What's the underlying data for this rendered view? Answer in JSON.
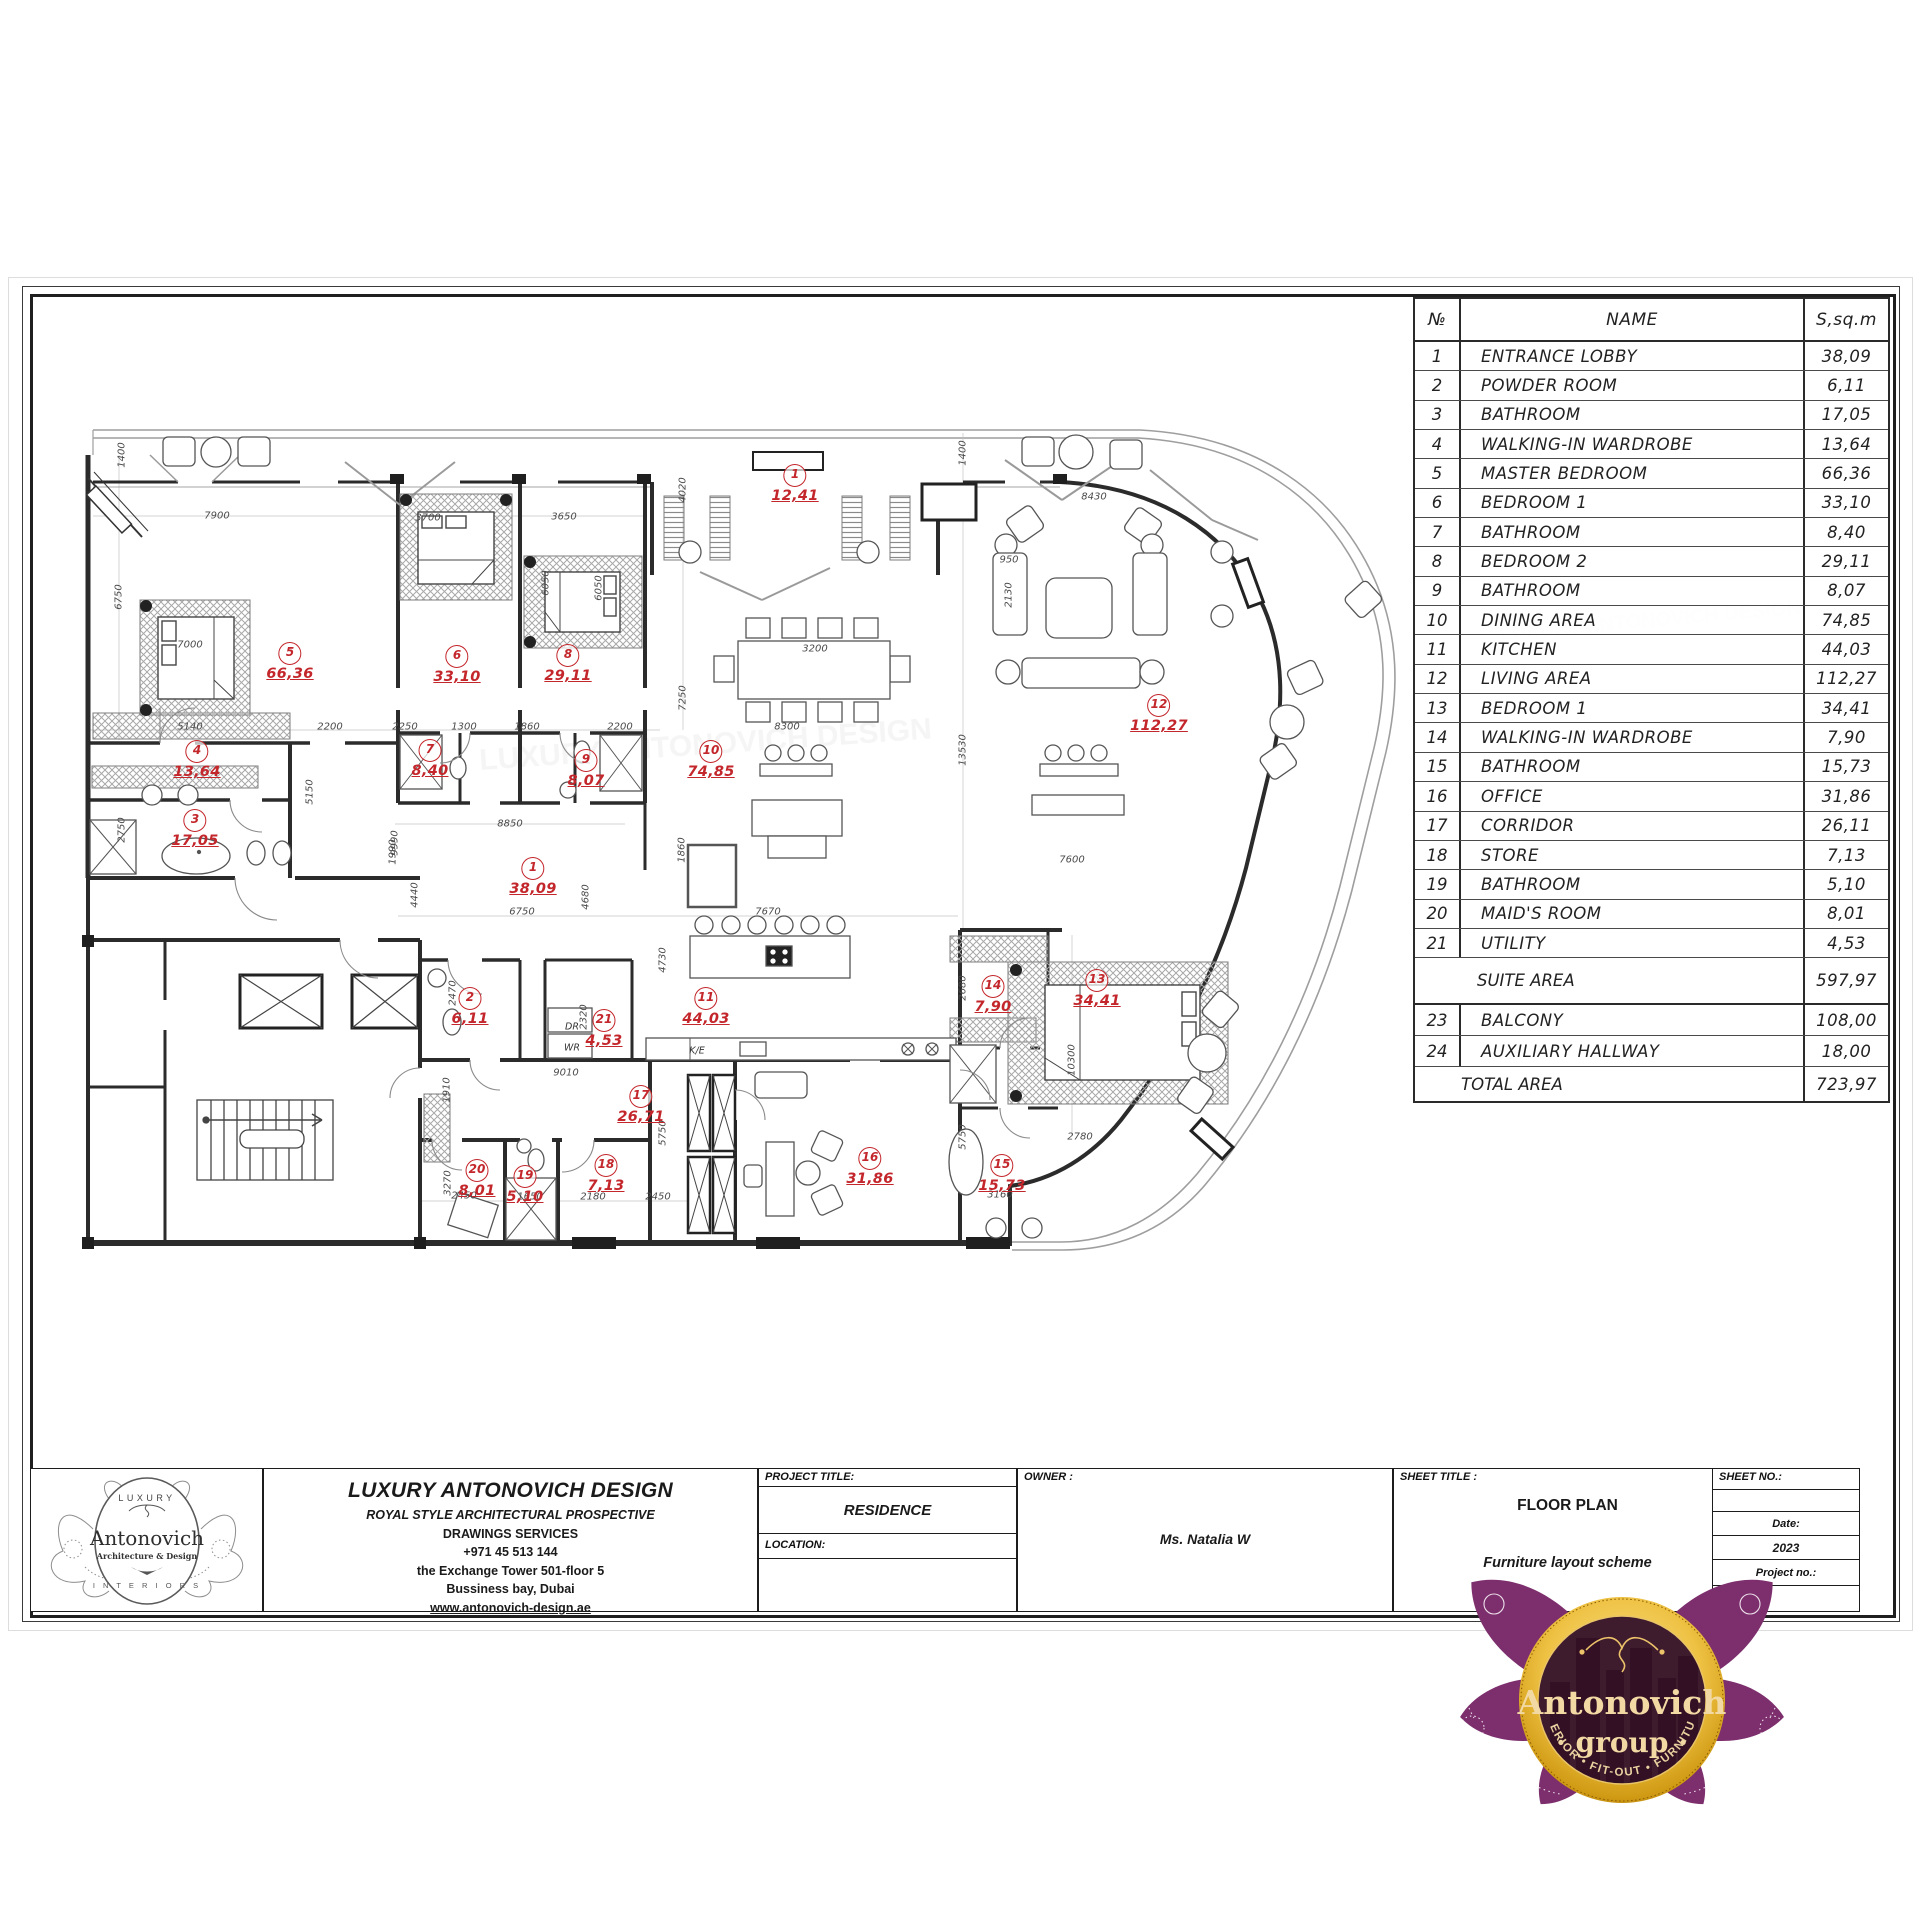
{
  "table": {
    "headers": {
      "no": "№",
      "name": "NAME",
      "area": "S,sq.m"
    },
    "rows": [
      {
        "no": "1",
        "name": "ENTRANCE LOBBY",
        "area": "38,09"
      },
      {
        "no": "2",
        "name": "POWDER ROOM",
        "area": "6,11"
      },
      {
        "no": "3",
        "name": "BATHROOM",
        "area": "17,05"
      },
      {
        "no": "4",
        "name": "WALKING-IN WARDROBE",
        "area": "13,64"
      },
      {
        "no": "5",
        "name": "MASTER BEDROOM",
        "area": "66,36"
      },
      {
        "no": "6",
        "name": "BEDROOM 1",
        "area": "33,10"
      },
      {
        "no": "7",
        "name": "BATHROOM",
        "area": "8,40"
      },
      {
        "no": "8",
        "name": "BEDROOM 2",
        "area": "29,11"
      },
      {
        "no": "9",
        "name": "BATHROOM",
        "area": "8,07"
      },
      {
        "no": "10",
        "name": "DINING AREA",
        "area": "74,85"
      },
      {
        "no": "11",
        "name": "KITCHEN",
        "area": "44,03"
      },
      {
        "no": "12",
        "name": "LIVING AREA",
        "area": "112,27"
      },
      {
        "no": "13",
        "name": "BEDROOM 1",
        "area": "34,41"
      },
      {
        "no": "14",
        "name": "WALKING-IN WARDROBE",
        "area": "7,90"
      },
      {
        "no": "15",
        "name": "BATHROOM",
        "area": "15,73"
      },
      {
        "no": "16",
        "name": "OFFICE",
        "area": "31,86"
      },
      {
        "no": "17",
        "name": "CORRIDOR",
        "area": "26,11"
      },
      {
        "no": "18",
        "name": "STORE",
        "area": "7,13"
      },
      {
        "no": "19",
        "name": "BATHROOM",
        "area": "5,10"
      },
      {
        "no": "20",
        "name": "MAID'S ROOM",
        "area": "8,01"
      },
      {
        "no": "21",
        "name": "UTILITY",
        "area": "4,53"
      }
    ],
    "suite": {
      "name": "SUITE AREA",
      "area": "597,97"
    },
    "extra_rows": [
      {
        "no": "23",
        "name": "BALCONY",
        "area": "108,00"
      },
      {
        "no": "24",
        "name": "AUXILIARY HALLWAY",
        "area": "18,00"
      }
    ],
    "total": {
      "name": "TOTAL AREA",
      "area": "723,97"
    }
  },
  "title_block": {
    "company": {
      "name": "LUXURY ANTONOVICH DESIGN",
      "line2": "ROYAL STYLE ARCHITECTURAL PROSPECTIVE",
      "line3": "DRAWINGS SERVICES",
      "phone": "+971 45 513 144",
      "address1": "the Exchange Tower 501-floor 5",
      "address2": "Bussiness bay, Dubai",
      "website": "www.antonovich-design.ae"
    },
    "labels": {
      "project_title": "PROJECT TITLE:",
      "location": "LOCATION:",
      "owner": "OWNER :",
      "sheet_title": "SHEET TITLE :",
      "sheet_no": "SHEET NO.:",
      "date": "Date:",
      "project_no": "Project no.:"
    },
    "values": {
      "project_title": "RESIDENCE",
      "owner": "Ms. Natalia W",
      "sheet_title": "FLOOR PLAN",
      "sheet_subtitle": "Furniture layout scheme",
      "date": "2023"
    }
  },
  "logo_small": {
    "top": "LUXURY",
    "name": "Antonovich",
    "sub": "Architecture & Design",
    "bottom": "I N T E R I O R S"
  },
  "logo_group": {
    "name": "Antonovich",
    "sub": "· group ·",
    "band": "INTERIOR • FIT-OUT • FURNITURE"
  },
  "plan": {
    "watermark": "LUXURY ANTONOVICH DESIGN",
    "room_labels": [
      {
        "no": "1",
        "area": "12,41",
        "x": 795,
        "y": 464
      },
      {
        "no": "5",
        "area": "66,36",
        "x": 290,
        "y": 642
      },
      {
        "no": "6",
        "area": "33,10",
        "x": 457,
        "y": 645
      },
      {
        "no": "8",
        "area": "29,11",
        "x": 568,
        "y": 644
      },
      {
        "no": "4",
        "area": "13,64",
        "x": 197,
        "y": 740
      },
      {
        "no": "7",
        "area": "8,40",
        "x": 430,
        "y": 739
      },
      {
        "no": "9",
        "area": "8,07",
        "x": 586,
        "y": 749
      },
      {
        "no": "10",
        "area": "74,85",
        "x": 711,
        "y": 740
      },
      {
        "no": "12",
        "area": "112,27",
        "x": 1159,
        "y": 694
      },
      {
        "no": "3",
        "area": "17,05",
        "x": 195,
        "y": 809
      },
      {
        "no": "1",
        "area": "38,09",
        "x": 533,
        "y": 857
      },
      {
        "no": "2",
        "area": "6,11",
        "x": 470,
        "y": 987
      },
      {
        "no": "21",
        "area": "4,53",
        "x": 604,
        "y": 1009
      },
      {
        "no": "11",
        "area": "44,03",
        "x": 706,
        "y": 987
      },
      {
        "no": "17",
        "area": "26,71",
        "x": 641,
        "y": 1085
      },
      {
        "no": "14",
        "area": "7,90",
        "x": 993,
        "y": 975
      },
      {
        "no": "13",
        "area": "34,41",
        "x": 1097,
        "y": 969
      },
      {
        "no": "20",
        "area": "8,01",
        "x": 477,
        "y": 1159
      },
      {
        "no": "19",
        "area": "5,10",
        "x": 525,
        "y": 1165
      },
      {
        "no": "18",
        "area": "7,13",
        "x": 606,
        "y": 1154
      },
      {
        "no": "16",
        "area": "31,86",
        "x": 870,
        "y": 1147
      },
      {
        "no": "15",
        "area": "15,73",
        "x": 1002,
        "y": 1154
      }
    ],
    "dims_h": [
      {
        "t": "7900",
        "x": 217,
        "y": 516
      },
      {
        "t": "3700",
        "x": 428,
        "y": 518
      },
      {
        "t": "3650",
        "x": 564,
        "y": 517
      },
      {
        "t": "8430",
        "x": 1094,
        "y": 497
      },
      {
        "t": "7000",
        "x": 190,
        "y": 645
      },
      {
        "t": "5140",
        "x": 190,
        "y": 727
      },
      {
        "t": "2200",
        "x": 330,
        "y": 727
      },
      {
        "t": "2250",
        "x": 405,
        "y": 727
      },
      {
        "t": "1300",
        "x": 464,
        "y": 727
      },
      {
        "t": "1860",
        "x": 527,
        "y": 727
      },
      {
        "t": "2200",
        "x": 620,
        "y": 727
      },
      {
        "t": "8300",
        "x": 787,
        "y": 727
      },
      {
        "t": "8850",
        "x": 510,
        "y": 824
      },
      {
        "t": "6750",
        "x": 522,
        "y": 912
      },
      {
        "t": "7670",
        "x": 768,
        "y": 912
      },
      {
        "t": "9010",
        "x": 566,
        "y": 1073
      },
      {
        "t": "2450",
        "x": 464,
        "y": 1196
      },
      {
        "t": "1650",
        "x": 530,
        "y": 1197
      },
      {
        "t": "2180",
        "x": 593,
        "y": 1197
      },
      {
        "t": "2450",
        "x": 658,
        "y": 1197
      },
      {
        "t": "7600",
        "x": 1072,
        "y": 860
      },
      {
        "t": "2780",
        "x": 1080,
        "y": 1137
      },
      {
        "t": "3160",
        "x": 1000,
        "y": 1195
      },
      {
        "t": "950",
        "x": 1009,
        "y": 560
      },
      {
        "t": "3200",
        "x": 815,
        "y": 649
      }
    ],
    "dims_v": [
      {
        "t": "1400",
        "x": 122,
        "y": 455
      },
      {
        "t": "1400",
        "x": 963,
        "y": 453
      },
      {
        "t": "4020",
        "x": 683,
        "y": 490
      },
      {
        "t": "6750",
        "x": 119,
        "y": 597
      },
      {
        "t": "6050",
        "x": 546,
        "y": 583
      },
      {
        "t": "6050",
        "x": 599,
        "y": 588
      },
      {
        "t": "7250",
        "x": 683,
        "y": 698
      },
      {
        "t": "13530",
        "x": 963,
        "y": 750
      },
      {
        "t": "2750",
        "x": 122,
        "y": 830
      },
      {
        "t": "5150",
        "x": 310,
        "y": 792
      },
      {
        "t": "9990",
        "x": 395,
        "y": 843
      },
      {
        "t": "1990",
        "x": 393,
        "y": 852
      },
      {
        "t": "4440",
        "x": 415,
        "y": 895
      },
      {
        "t": "4680",
        "x": 586,
        "y": 897
      },
      {
        "t": "1860",
        "x": 682,
        "y": 850
      },
      {
        "t": "4730",
        "x": 663,
        "y": 960
      },
      {
        "t": "2470",
        "x": 453,
        "y": 993
      },
      {
        "t": "2320",
        "x": 584,
        "y": 1017
      },
      {
        "t": "1910",
        "x": 447,
        "y": 1090
      },
      {
        "t": "5750",
        "x": 663,
        "y": 1133
      },
      {
        "t": "3270",
        "x": 448,
        "y": 1183
      },
      {
        "t": "2680",
        "x": 963,
        "y": 988
      },
      {
        "t": "10300",
        "x": 1072,
        "y": 1060
      },
      {
        "t": "5750",
        "x": 963,
        "y": 1137
      },
      {
        "t": "2130",
        "x": 1009,
        "y": 595
      }
    ],
    "small_texts": [
      {
        "t": "DR",
        "x": 572,
        "y": 1027
      },
      {
        "t": "WR",
        "x": 572,
        "y": 1048
      },
      {
        "t": "K/E",
        "x": 697,
        "y": 1051
      }
    ]
  }
}
